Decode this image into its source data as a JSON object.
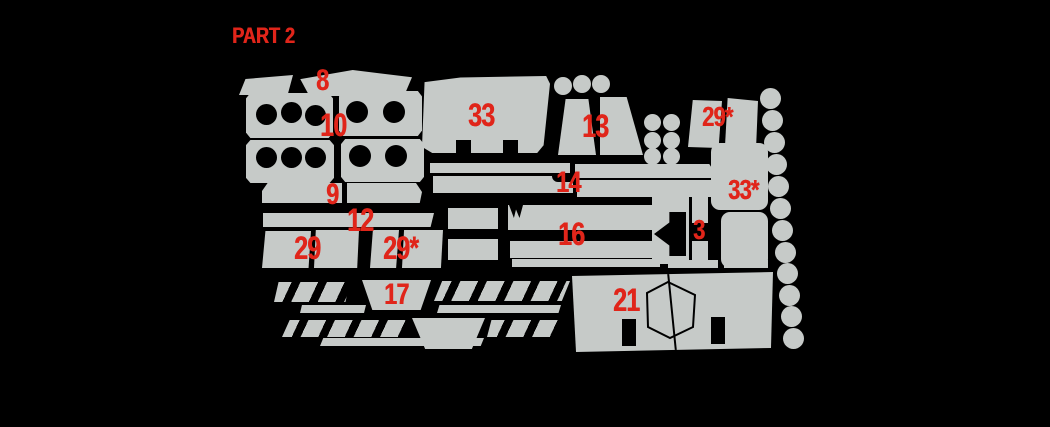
{
  "title": "PART 2",
  "colors": {
    "background": "#000000",
    "piece_fill": "#c6cac8",
    "label_red": "#e0251a"
  },
  "parts": {
    "p8": {
      "label": "8"
    },
    "p9": {
      "label": "9"
    },
    "p10": {
      "label": "10"
    },
    "p12": {
      "label": "12"
    },
    "p13": {
      "label": "13"
    },
    "p14": {
      "label": "14"
    },
    "p16": {
      "label": "16"
    },
    "p17": {
      "label": "17"
    },
    "p21": {
      "label": "21"
    },
    "p29": {
      "label": "29"
    },
    "p29star_top": {
      "label": "29*"
    },
    "p29star_mid": {
      "label": "29*"
    },
    "p3": {
      "label": "3"
    },
    "p33": {
      "label": "33"
    },
    "p33star": {
      "label": "33*"
    }
  },
  "circles": {
    "top_row_count": 3,
    "side_grid_count": 6,
    "right_column_count": 12
  }
}
